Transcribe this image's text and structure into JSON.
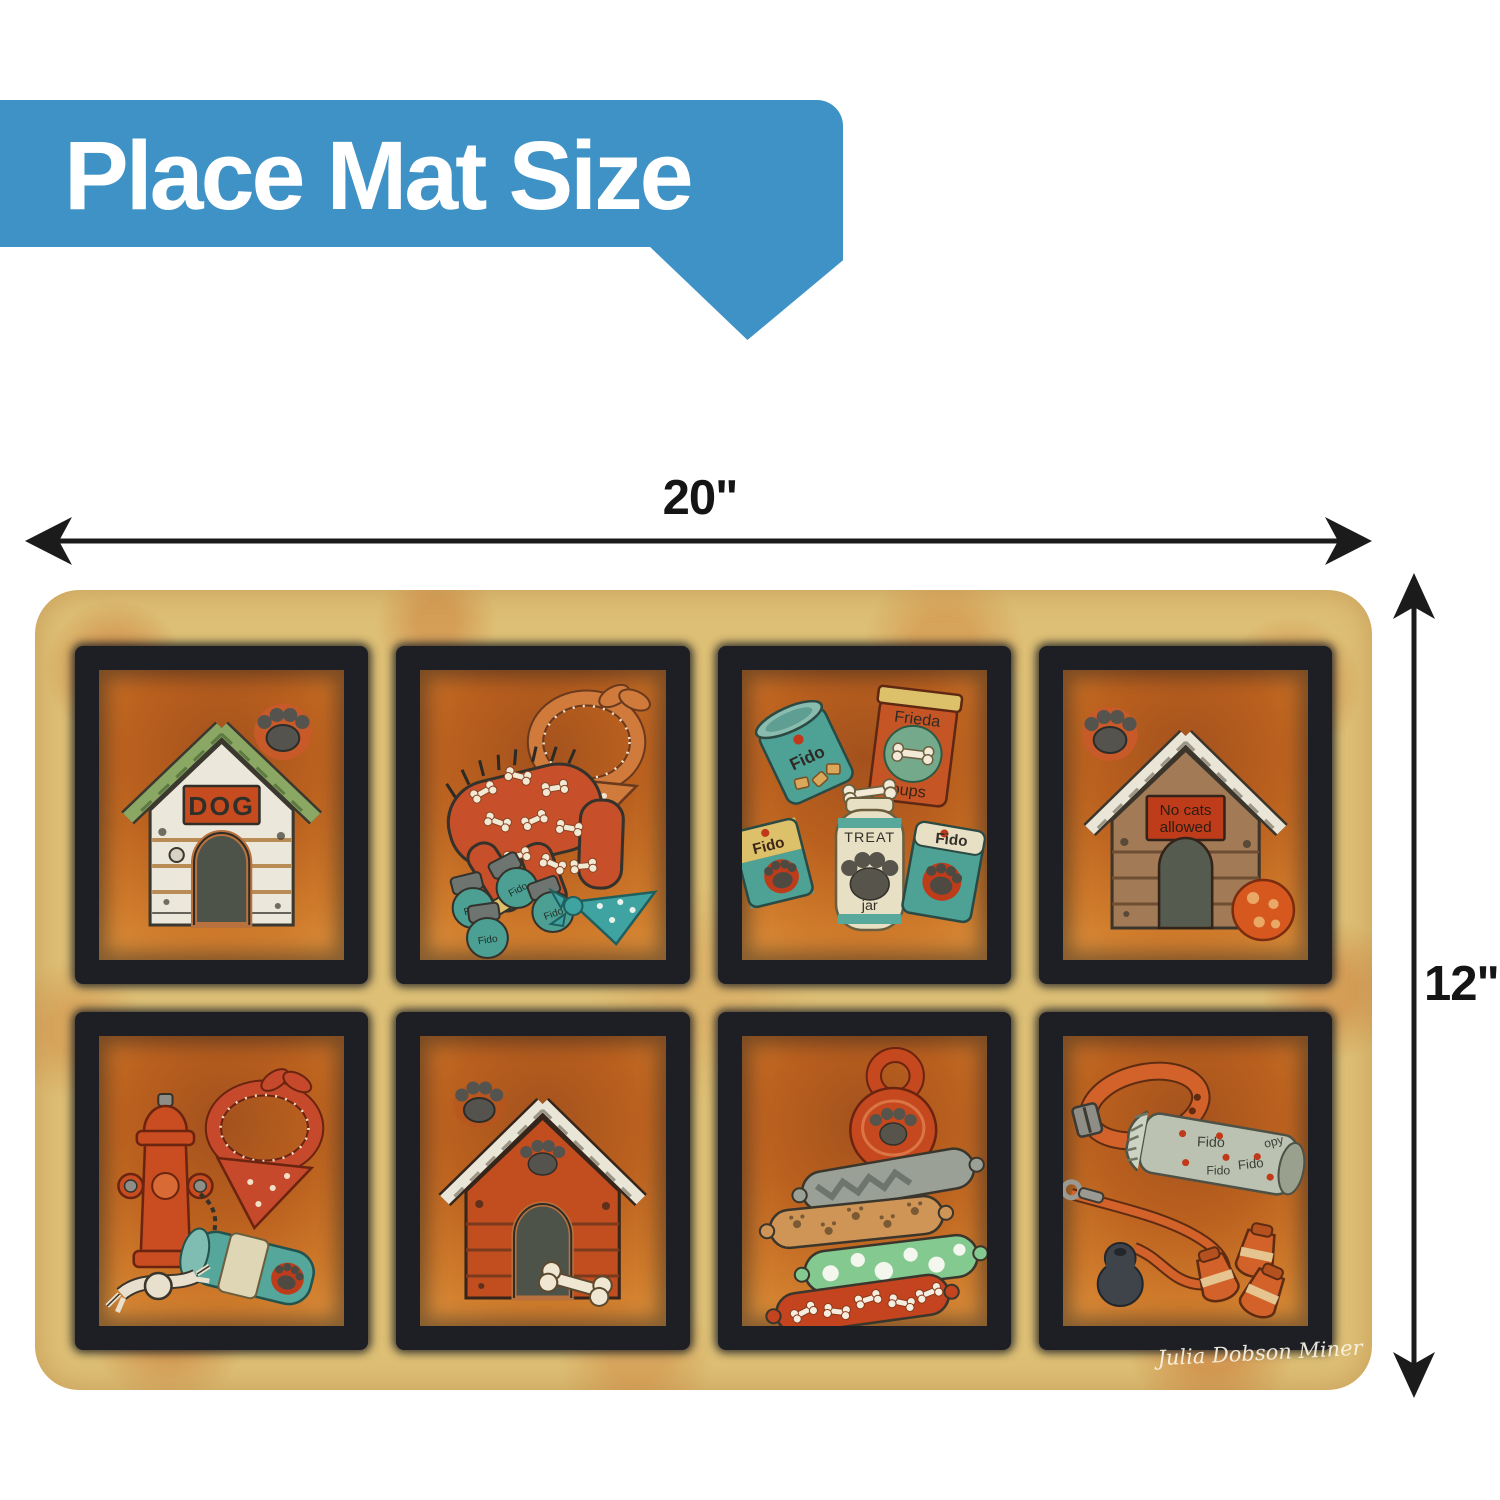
{
  "banner": {
    "label": "Place Mat Size",
    "bg_color": "#3e92c6",
    "text_color": "#ffffff"
  },
  "dimensions": {
    "width_label": "20\"",
    "height_label": "12\"",
    "arrow_color": "#1b1b1b"
  },
  "mat": {
    "base_color": "#ddbf75",
    "frame_color": "#1d1f25",
    "panel_orange": "#c4691f",
    "signature": "Julia Dobson Miner",
    "panel1": {
      "name": "white-doghouse",
      "sign": "DOG"
    },
    "panel2": {
      "name": "dog-clothes",
      "bootie_label": "Fido"
    },
    "panel3": {
      "name": "dog-food",
      "can1": "Fido",
      "bag1_top": "Frieda",
      "bag1_bottom": "pups",
      "can2": "Fido",
      "jar_top": "TREAT",
      "jar_bottom": "jar",
      "bag2": "Fido"
    },
    "panel4": {
      "name": "no-cats-doghouse",
      "sign_line1": "No cats",
      "sign_line2": "allowed"
    },
    "panel5": {
      "name": "fire-hydrant-toys"
    },
    "panel6": {
      "name": "red-doghouse"
    },
    "panel7": {
      "name": "stuffed-toys"
    },
    "panel8": {
      "name": "leash-collar-paper",
      "paper_word1": "Fido",
      "paper_word2": "opy"
    }
  }
}
